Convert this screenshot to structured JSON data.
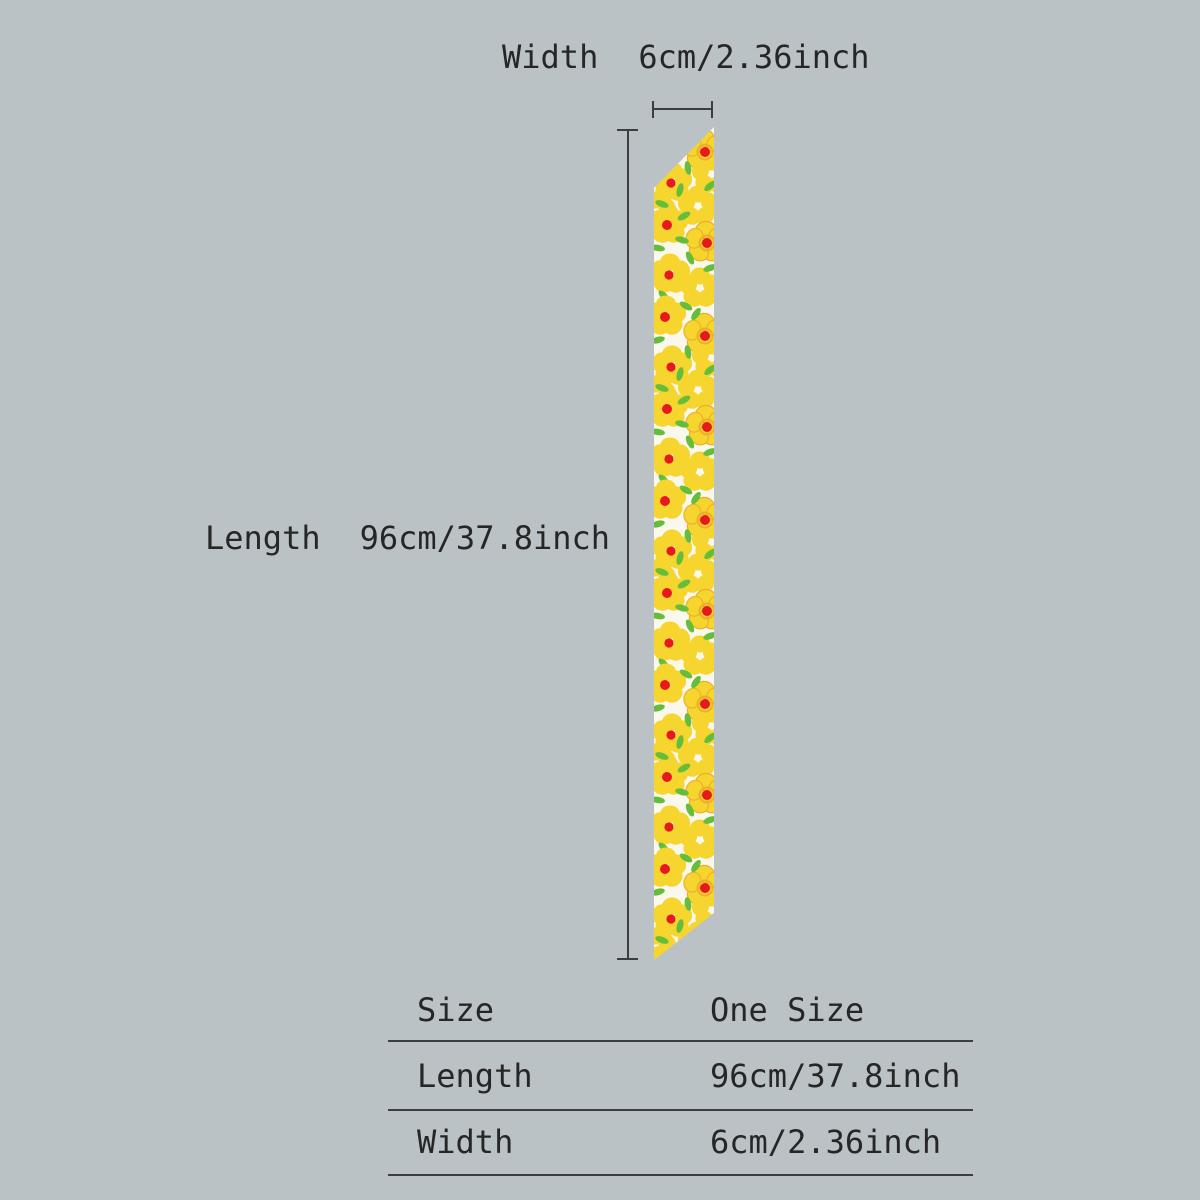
{
  "colors": {
    "background": "#bac2c6",
    "text": "#262626",
    "line": "#3b3e40",
    "scarf_base": "#faf7ec",
    "flower_yellow": "#f6d52f",
    "flower_outline": "#edaf2b",
    "flower_red": "#e8191c",
    "leaf_green": "#64be3b"
  },
  "annotations": {
    "width_label": "Width",
    "width_value": "6cm/2.36inch",
    "length_label": "Length",
    "length_value": "96cm/37.8inch"
  },
  "size_table": {
    "rows": [
      {
        "label": "Size",
        "value": "One Size"
      },
      {
        "label": "Length",
        "value": "96cm/37.8inch"
      },
      {
        "label": "Width",
        "value": "6cm/2.36inch"
      }
    ]
  }
}
